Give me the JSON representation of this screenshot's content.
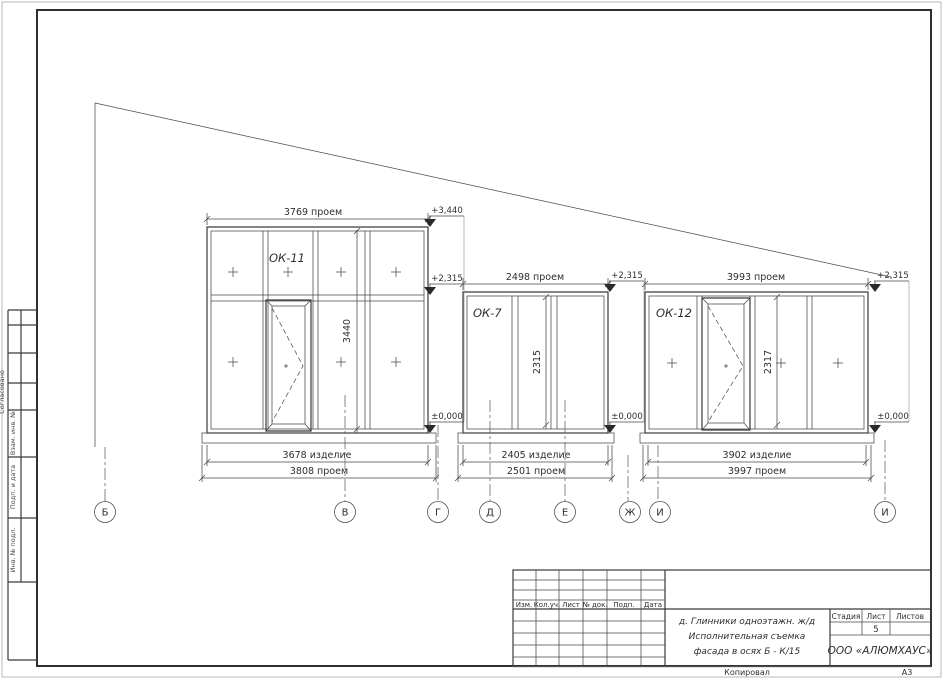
{
  "sheet": {
    "format": "А3",
    "copy_label": "Копировал"
  },
  "left_margin": {
    "approved_label": "Согласовано",
    "replace_inv_label": "Взам. инв. №",
    "sign_date_label": "Подп. и дата",
    "orig_inv_label": "Инв. № подл."
  },
  "drawing": {
    "windows": [
      {
        "label": "ОК-11",
        "opening_top": "3769 проем",
        "height": "3440",
        "product": "3678 изделие",
        "opening_bottom": "3808 проем"
      },
      {
        "label": "ОК-7",
        "opening_top": "2498 проем",
        "height": "2315",
        "product": "2405 изделие",
        "opening_bottom": "2501 проем"
      },
      {
        "label": "ОК-12",
        "opening_top": "3993 проем",
        "height": "2317",
        "product": "3902 изделие",
        "opening_bottom": "3997 проем"
      }
    ],
    "elevations": {
      "roof": "+3,440",
      "lintel": "+2,315",
      "zero": "±0,000"
    },
    "axes": [
      "Б",
      "В",
      "Г",
      "Д",
      "Е",
      "Ж",
      "И",
      "И"
    ]
  },
  "title_block": {
    "revision_headers": [
      "Изм.",
      "Кол.уч.",
      "Лист",
      "№ док.",
      "Подп.",
      "Дата"
    ],
    "project_lines": [
      "д. Глинники одноэтажн. ж/д",
      "Исполнительная съемка",
      "фасада в осях Б - К/15"
    ],
    "stage_header": "Стадия",
    "sheet_header": "Лист",
    "sheets_header": "Листов",
    "sheet_number": "5",
    "company": "ООО «АЛЮМХАУС»"
  }
}
